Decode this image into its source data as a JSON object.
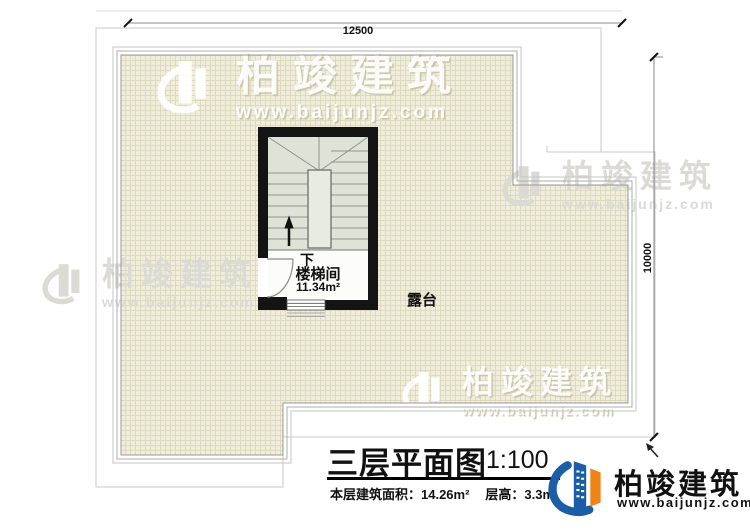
{
  "dimensions": {
    "top": "12500",
    "right": "10000"
  },
  "rooms": {
    "stair": {
      "direction": "下",
      "label": "楼梯间",
      "area": "11.34m²"
    },
    "terrace": {
      "label": "露台"
    }
  },
  "titleblock": {
    "title": "三层平面图",
    "scale": "1:100",
    "area_info": "本层建筑面积：14.26m²",
    "floor_height": "层高：3.3m"
  },
  "brand": {
    "name": "柏竣建筑",
    "url": "www.baijunjz.com"
  },
  "watermark": {
    "name": "柏竣建筑",
    "url": "www.baijunjz.com"
  },
  "colors": {
    "brand_blue": "#1b5ea6",
    "brand_orange": "#ef8318",
    "tile": "#f0edda",
    "tile_line": "#ded9c1",
    "wall": "#141414"
  }
}
